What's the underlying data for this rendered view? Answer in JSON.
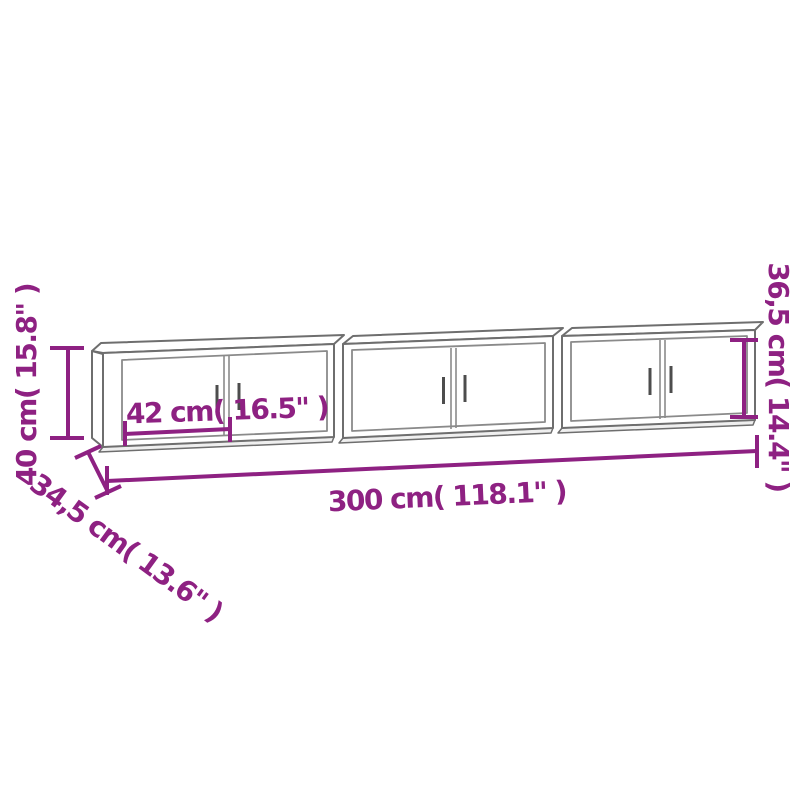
{
  "diagram": {
    "type": "furniture-dimension-diagram",
    "subject": "three wall-mounted cabinets drawn in light-gray outline with purple dimension lines",
    "colors": {
      "accent": "#8E2182",
      "line": "#6E6E6E",
      "background": "#FFFFFF"
    },
    "labels": {
      "overall_height": "40 cm( 15.8\" )",
      "door_width": "42 cm( 16.5\" )",
      "overall_width": "300 cm( 118.1\" )",
      "unit_height": "36,5 cm( 14.4\" )",
      "depth": "34,5 cm( 13.6\" )"
    },
    "dimensions": [
      {
        "name": "overall height",
        "cm": "40",
        "inches": "15.8",
        "orientation": "vertical-left"
      },
      {
        "name": "door width",
        "cm": "42",
        "inches": "16.5",
        "orientation": "horizontal-inside-left-cabinet"
      },
      {
        "name": "overall width",
        "cm": "300",
        "inches": "118.1",
        "orientation": "horizontal-bottom"
      },
      {
        "name": "unit height",
        "cm": "36,5",
        "inches": "14.4",
        "orientation": "vertical-right"
      },
      {
        "name": "depth",
        "cm": "34,5",
        "inches": "13.6",
        "orientation": "diagonal-bottom-left"
      }
    ],
    "cabinet_count": 3,
    "doors_per_cabinet": 2
  }
}
